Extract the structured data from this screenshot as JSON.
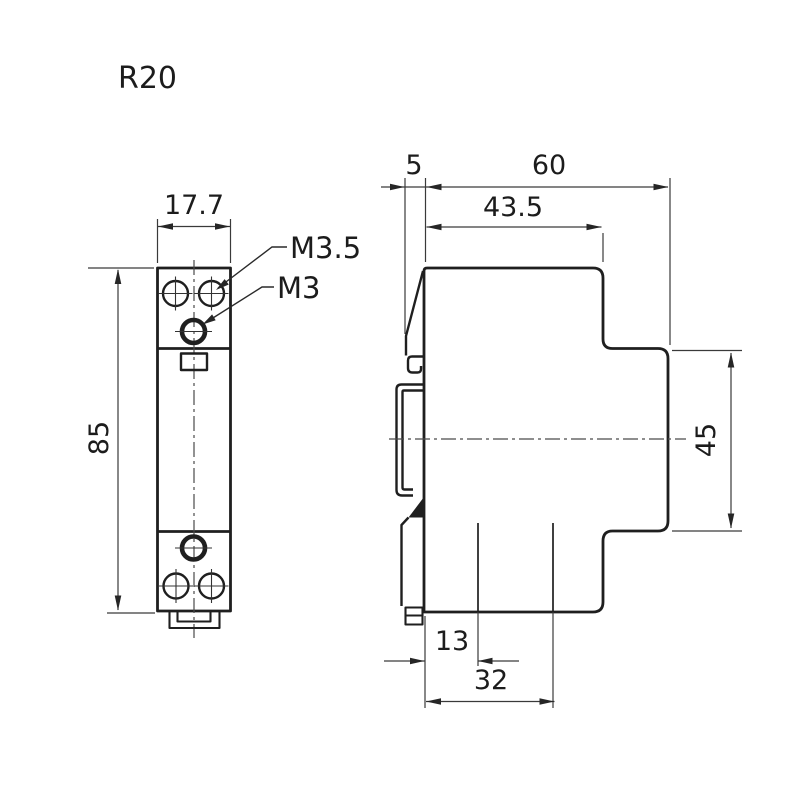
{
  "drawing": {
    "model": "R20",
    "front_view": {
      "width": "17.7",
      "height": "85",
      "screw_label_top": "M3.5",
      "screw_label_mid": "M3"
    },
    "side_view": {
      "din_offset": "5",
      "overall_depth": "60",
      "upper_body_depth": "43.5",
      "din_rail_height": "45",
      "terminal_inset": "13",
      "terminal_span": "32"
    },
    "colors": {
      "line": "#1f1f1f",
      "thin_line": "#3a3a3a",
      "background": "#ffffff"
    }
  }
}
